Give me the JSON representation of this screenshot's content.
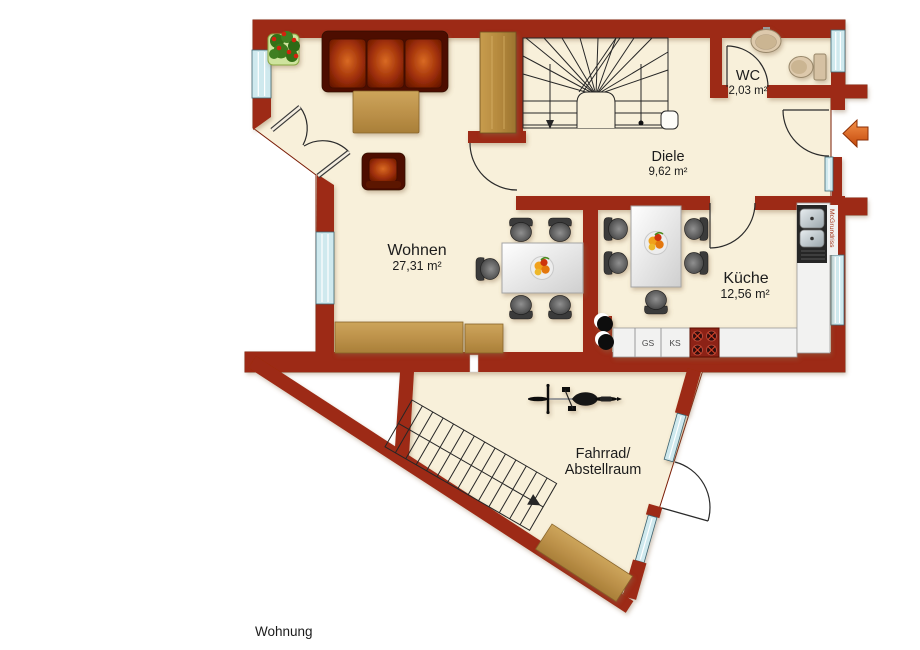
{
  "plan": {
    "caption": "Wohnung",
    "watermark": "McGrundriss",
    "rooms": {
      "wohnen": {
        "name": "Wohnen",
        "area": "27,31 m²"
      },
      "diele": {
        "name": "Diele",
        "area": "9,62 m²"
      },
      "wc": {
        "name": "WC",
        "area": "2,03 m²"
      },
      "kueche": {
        "name": "Küche",
        "area": "12,56 m²"
      },
      "abstellraum": {
        "line1": "Fahrrad/",
        "line2": "Abstellraum"
      }
    },
    "kitchen_units": {
      "dishwasher": "GS",
      "fridge": "KS"
    },
    "colors": {
      "wall": "#9d2c12",
      "floor": "#f8f0da",
      "window_glass": "#cfe9ee",
      "wood": "#c09a52",
      "entry_arrow": "#e06a20"
    }
  }
}
